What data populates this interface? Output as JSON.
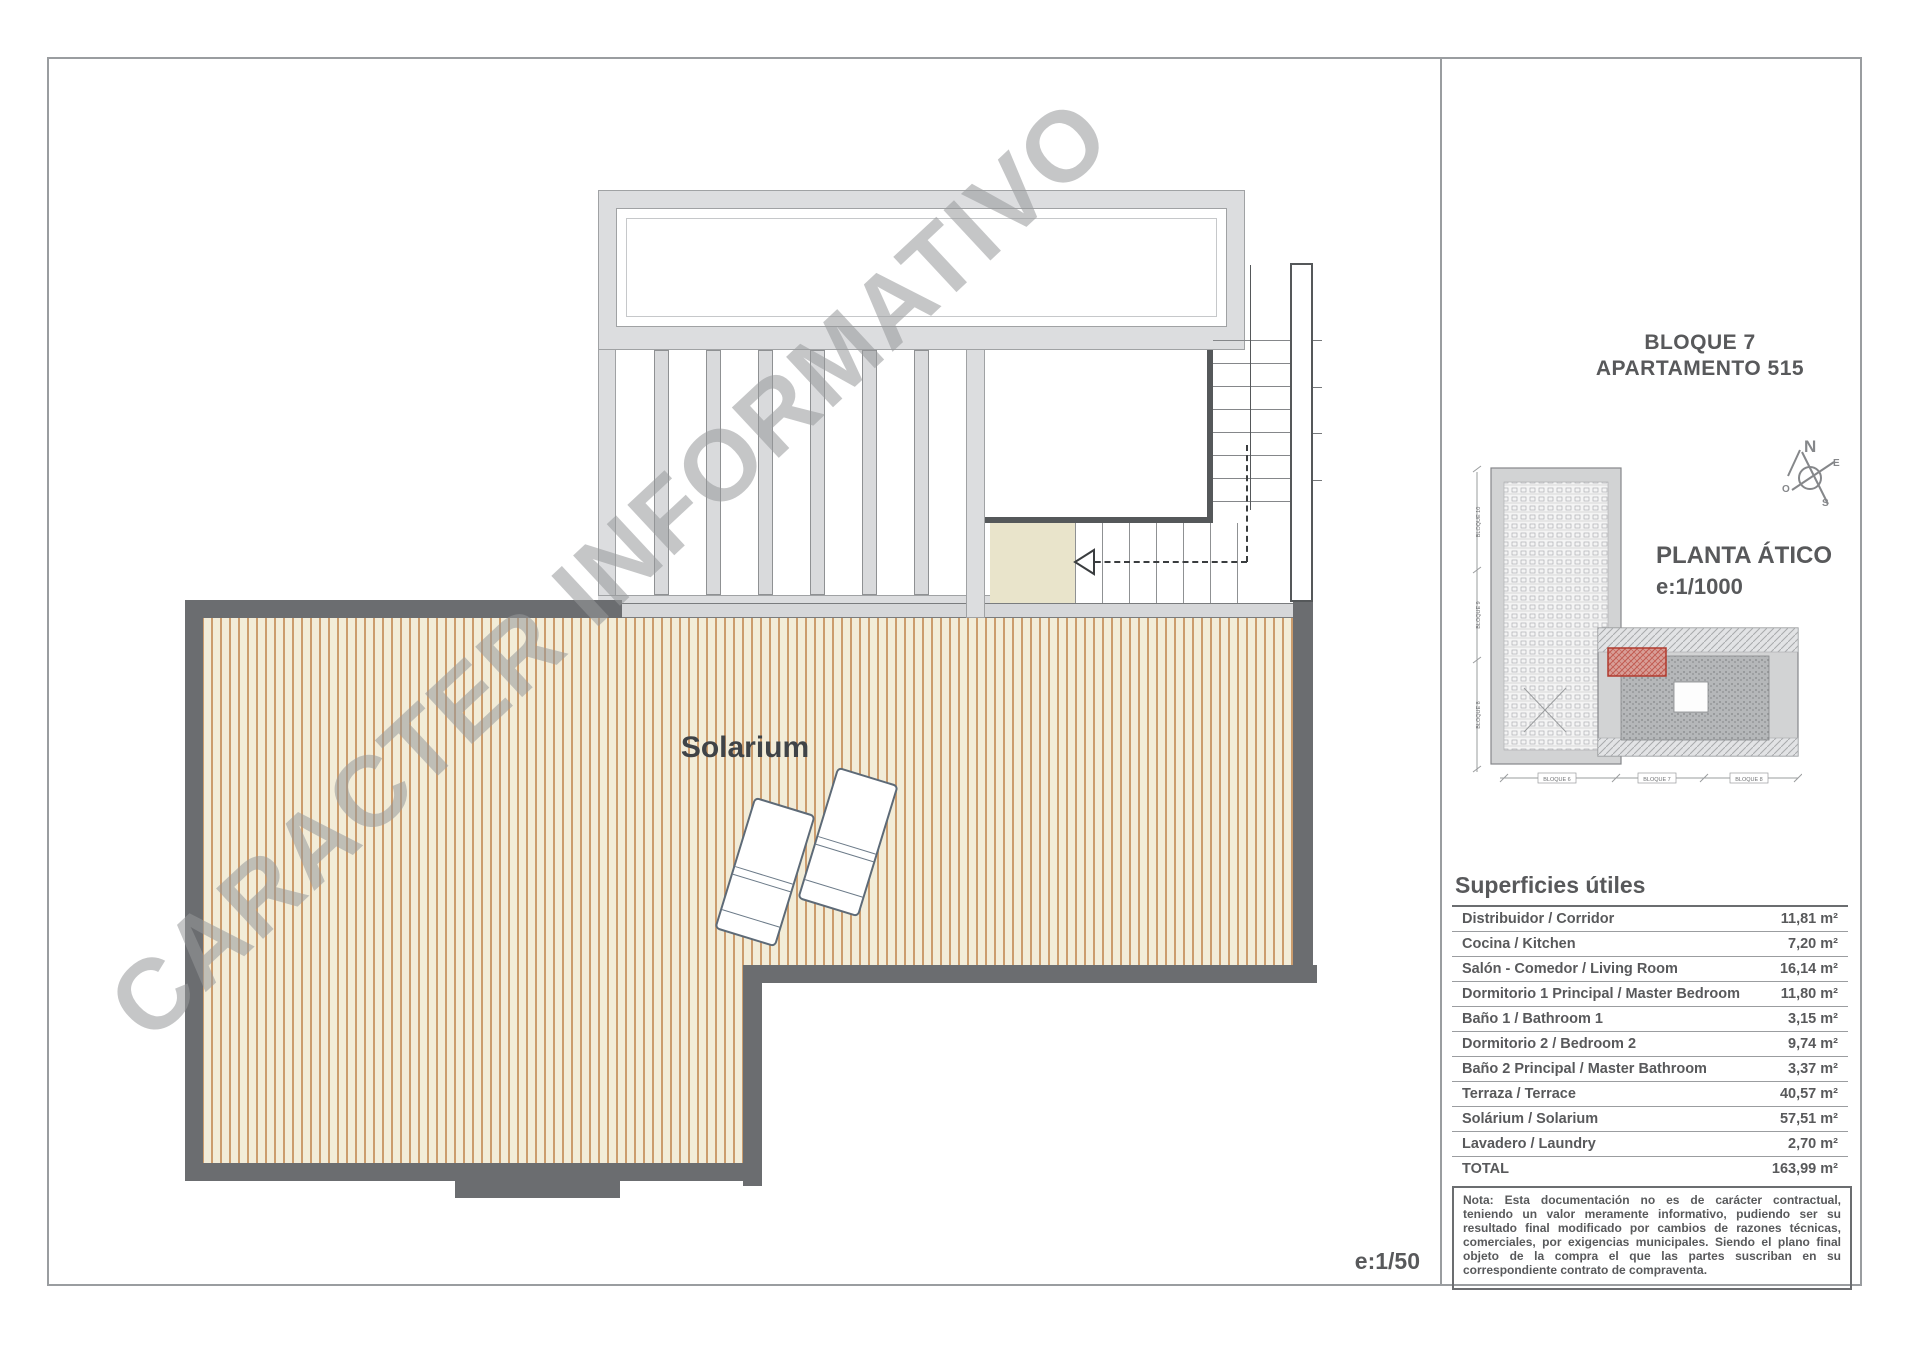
{
  "header": {
    "line1": "BLOQUE 7",
    "line2": "APARTAMENTO 515"
  },
  "plan": {
    "room_label": "Solarium",
    "watermark": "CARACTER INFORMATIVO",
    "scale_label": "e:1/50"
  },
  "locator": {
    "title": "PLANTA ÁTICO",
    "scale": "e:1/1000",
    "compass": {
      "n": "N",
      "e": "E",
      "s": "S",
      "o": "O"
    },
    "left_labels": [
      "BLOQUE 10",
      "BLOQUE 9",
      "BLOQUE 8"
    ],
    "bottom_labels": [
      "BLOQUE 6",
      "BLOQUE 7",
      "BLOQUE 8"
    ]
  },
  "surfaces": {
    "title": "Superficies útiles",
    "rows": [
      {
        "label": "Distribuidor / Corridor",
        "value": "11,81 m²"
      },
      {
        "label": "Cocina / Kitchen",
        "value": "7,20 m²"
      },
      {
        "label": "Salón - Comedor / Living Room",
        "value": "16,14 m²"
      },
      {
        "label": "Dormitorio 1 Principal / Master Bedroom",
        "value": "11,80 m²"
      },
      {
        "label": "Baño 1 / Bathroom 1",
        "value": "3,15 m²"
      },
      {
        "label": "Dormitorio 2 / Bedroom 2",
        "value": "9,74 m²"
      },
      {
        "label": "Baño 2 Principal / Master Bathroom",
        "value": "3,37 m²"
      },
      {
        "label": "Terraza / Terrace",
        "value": "40,57 m²"
      },
      {
        "label": "Solárium  / Solarium",
        "value": "57,51 m²"
      },
      {
        "label": "Lavadero  / Laundry",
        "value": "2,70 m²"
      },
      {
        "label": "TOTAL",
        "value": "163,99 m²"
      }
    ]
  },
  "note": {
    "text": "Nota: Esta documentación no es de carácter contractual, teniendo un valor meramente informativo, pudiendo ser su resultado final modificado por cambios de razones técnicas, comerciales, por exigencias municipales. Siendo el plano final objeto de la compra el que las partes suscriban en su correspondiente contrato de compraventa."
  },
  "colors": {
    "wall_gray": "#6b6d70",
    "interior_wall": "#55585a",
    "pergola_gray": "#dcdddf",
    "deck_background": "#f2ecd8",
    "deck_stripe": "#cb9c6d",
    "landing_beige": "#e9e4cb",
    "text_gray": "#58595b",
    "highlight_red": "#b03a2e"
  }
}
